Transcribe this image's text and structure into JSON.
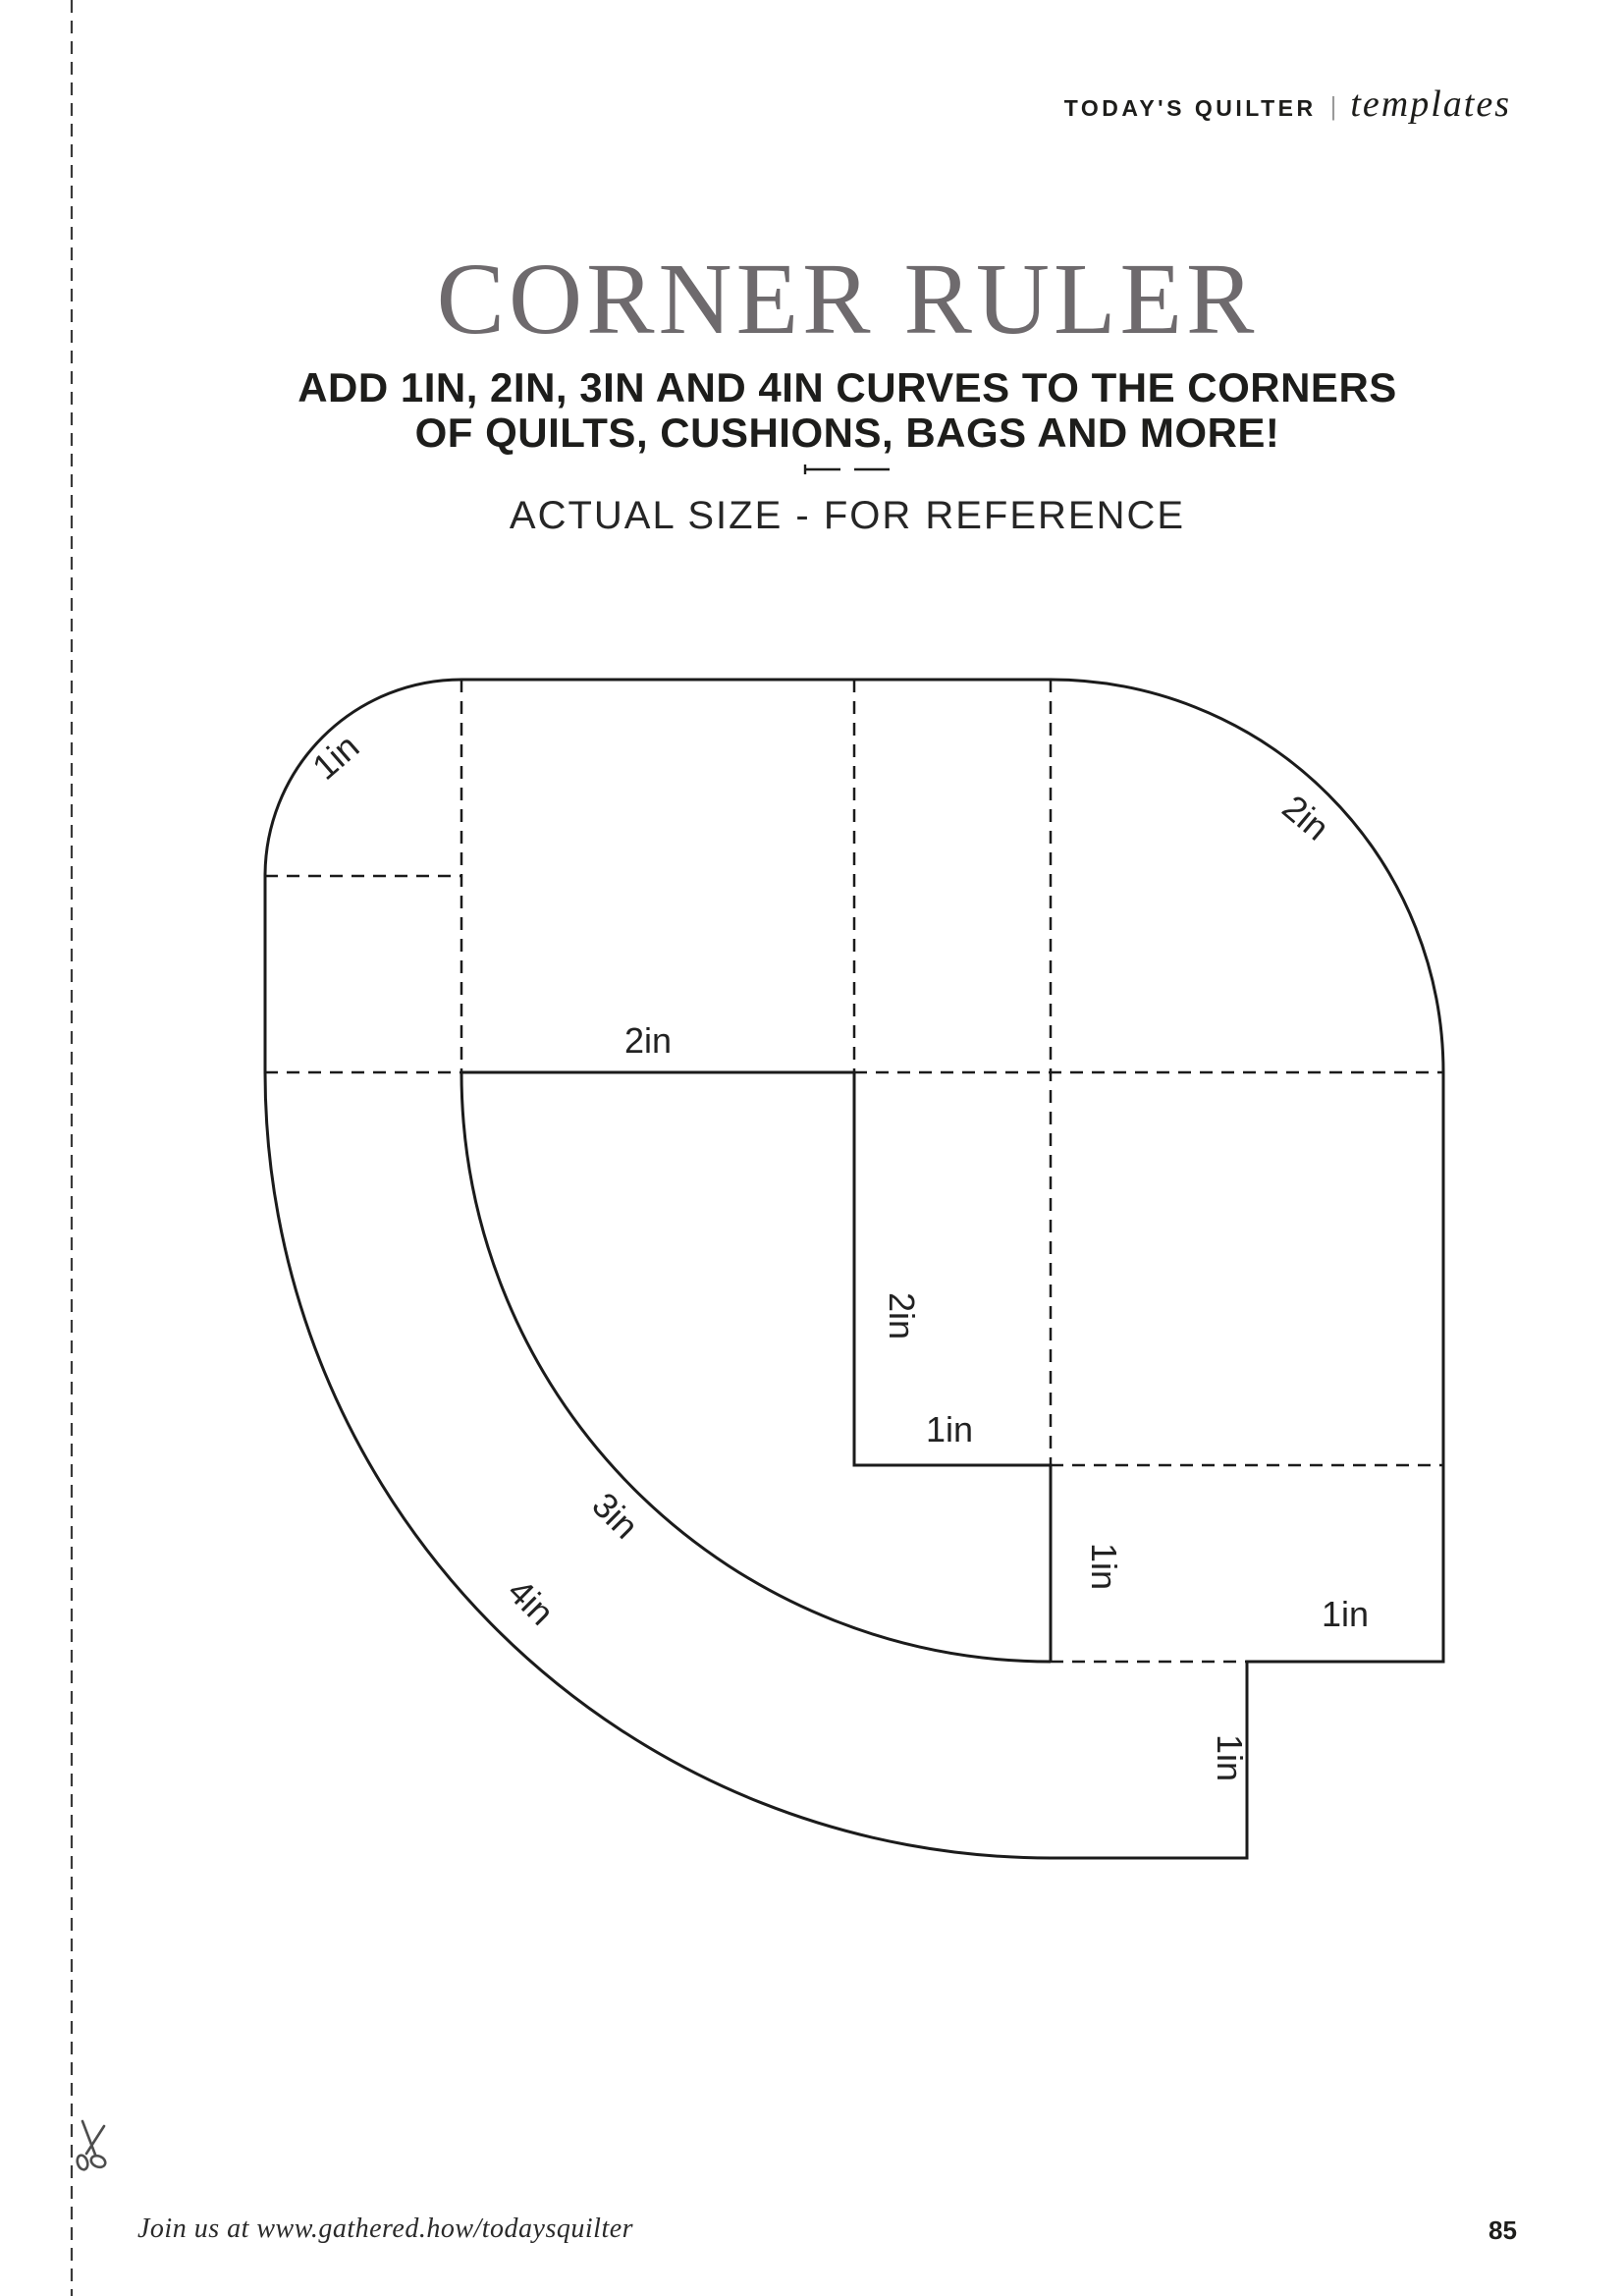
{
  "header": {
    "brand": "TODAY'S QUILTER",
    "separator": "|",
    "section": "templates"
  },
  "hero": {
    "title": "CORNER RULER",
    "subtitle_line1": "ADD 1IN, 2IN, 3IN AND 4IN CURVES TO THE CORNERS",
    "subtitle_line2": "OF QUILTS, CUSHIONS, BAGS AND MORE!",
    "note": "ACTUAL SIZE - FOR REFERENCE"
  },
  "diagram": {
    "labels": {
      "curve_1in": "1in",
      "curve_2in": "2in",
      "mid_2in_horizontal": "2in",
      "mid_2in_vertical": "2in",
      "step_1in_horizontal": "1in",
      "step_1in_vertical": "1in",
      "right_1in_horizontal": "1in",
      "right_1in_vertical": "1in",
      "curve_3in": "3in",
      "curve_4in": "4in"
    }
  },
  "footer": {
    "join_text": "Join us at www.gathered.how/todaysquilter",
    "page_number": "85"
  },
  "colors": {
    "title_gray": "#6e6a6d",
    "ink_black": "#1d1d1b",
    "line_black": "#1b1b1b",
    "cutline_gray": "#3a3a3a"
  }
}
